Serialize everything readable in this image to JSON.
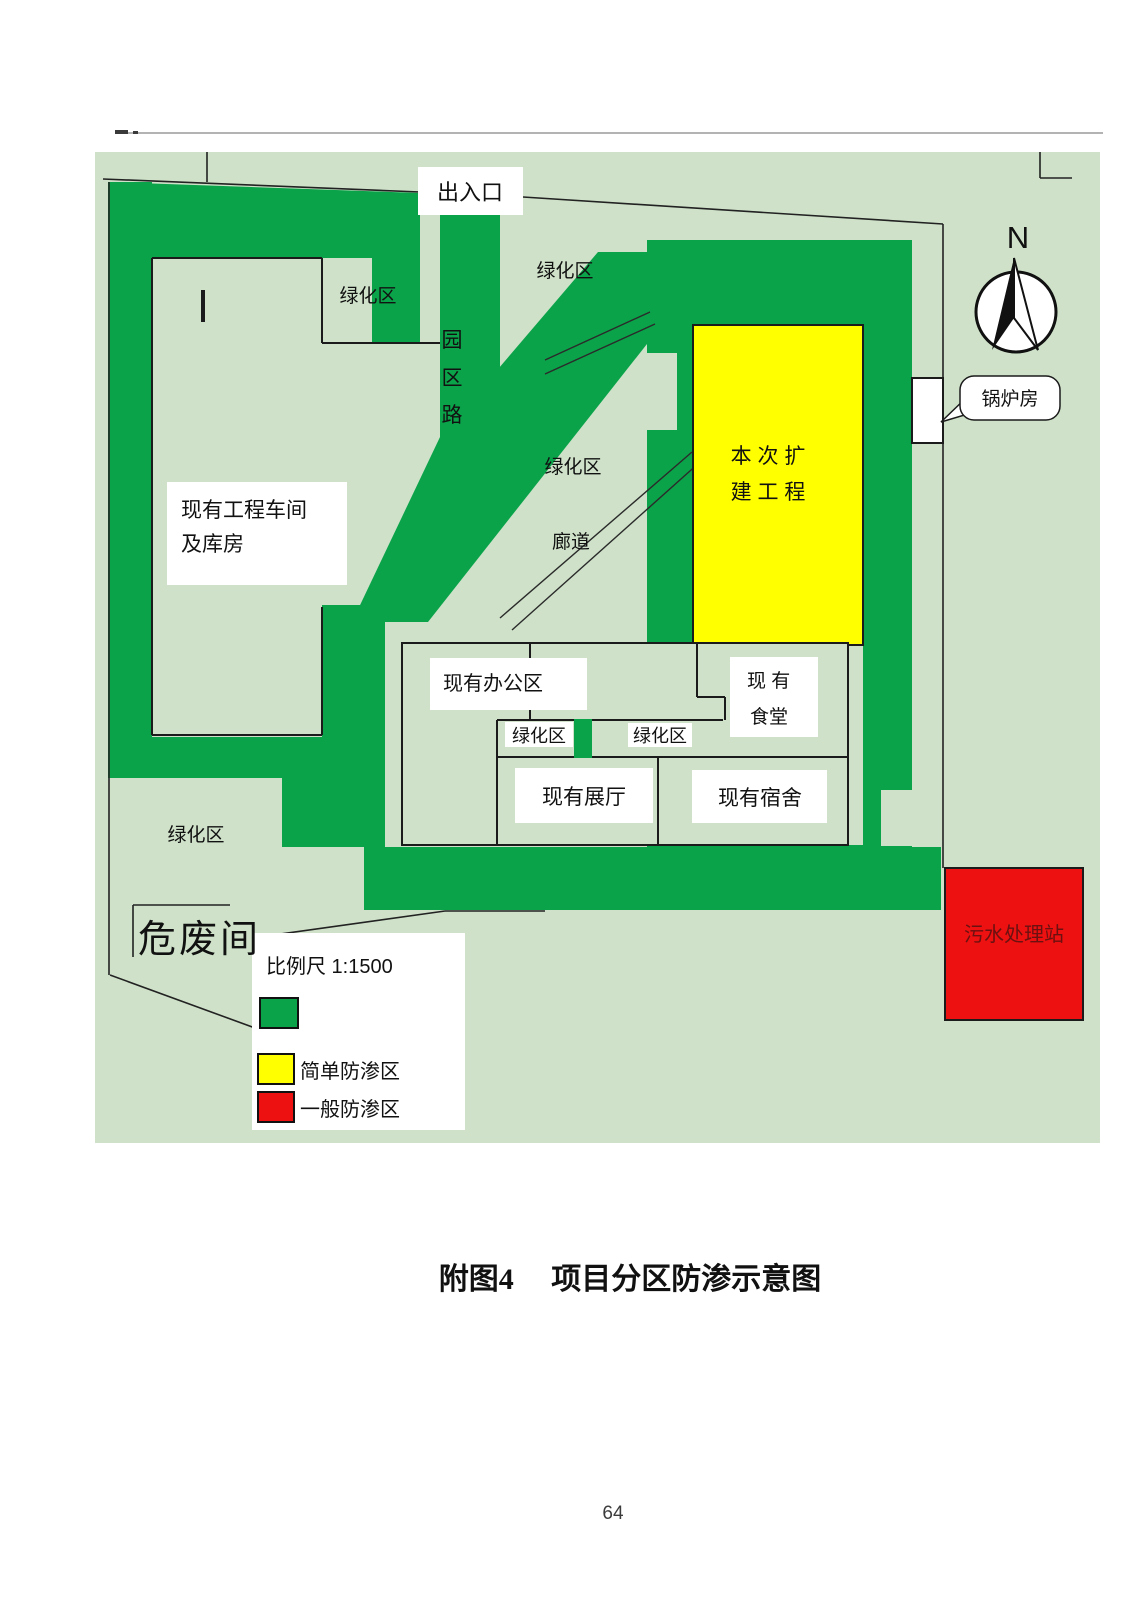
{
  "page": {
    "caption": "附图4　 项目分区防渗示意图",
    "number": "64"
  },
  "colors": {
    "map_background": "#cfe2c9",
    "greenbelt_green": "#0ba34a",
    "expansion_yellow": "#ffff00",
    "sewage_red": "#ee1111",
    "label_white": "#ffffff",
    "outline_black": "#1b1b1b"
  },
  "map": {
    "labels": {
      "entrance": "出入口",
      "greening_top_left": "绿化区",
      "greening_top_mid": "绿化区",
      "park_road_char1": "园",
      "park_road_char2": "区",
      "park_road_char3": "路",
      "workshop_line1": "现有工程车间",
      "workshop_line2": "及库房",
      "greening_mid": "绿化区",
      "corridor": "廊道",
      "expansion_line1": "本 次 扩",
      "expansion_line2": "建 工 程",
      "boiler_room": "锅炉房",
      "north": "N",
      "office": "现有办公区",
      "canteen_line1": "现  有",
      "canteen_line2": "食堂",
      "greening_small_left": "绿化区",
      "greening_small_right": "绿化区",
      "exhibition_hall": "现有展厅",
      "dormitory": "现有宿舍",
      "greening_bottom_left": "绿化区",
      "hazardous_waste_room": "危废间",
      "sewage_station": "污水处理站"
    },
    "legend": {
      "scale_label": "比例尺  1:1500",
      "simple_zone_label": "简单防渗区",
      "general_zone_label": "一般防渗区"
    }
  }
}
